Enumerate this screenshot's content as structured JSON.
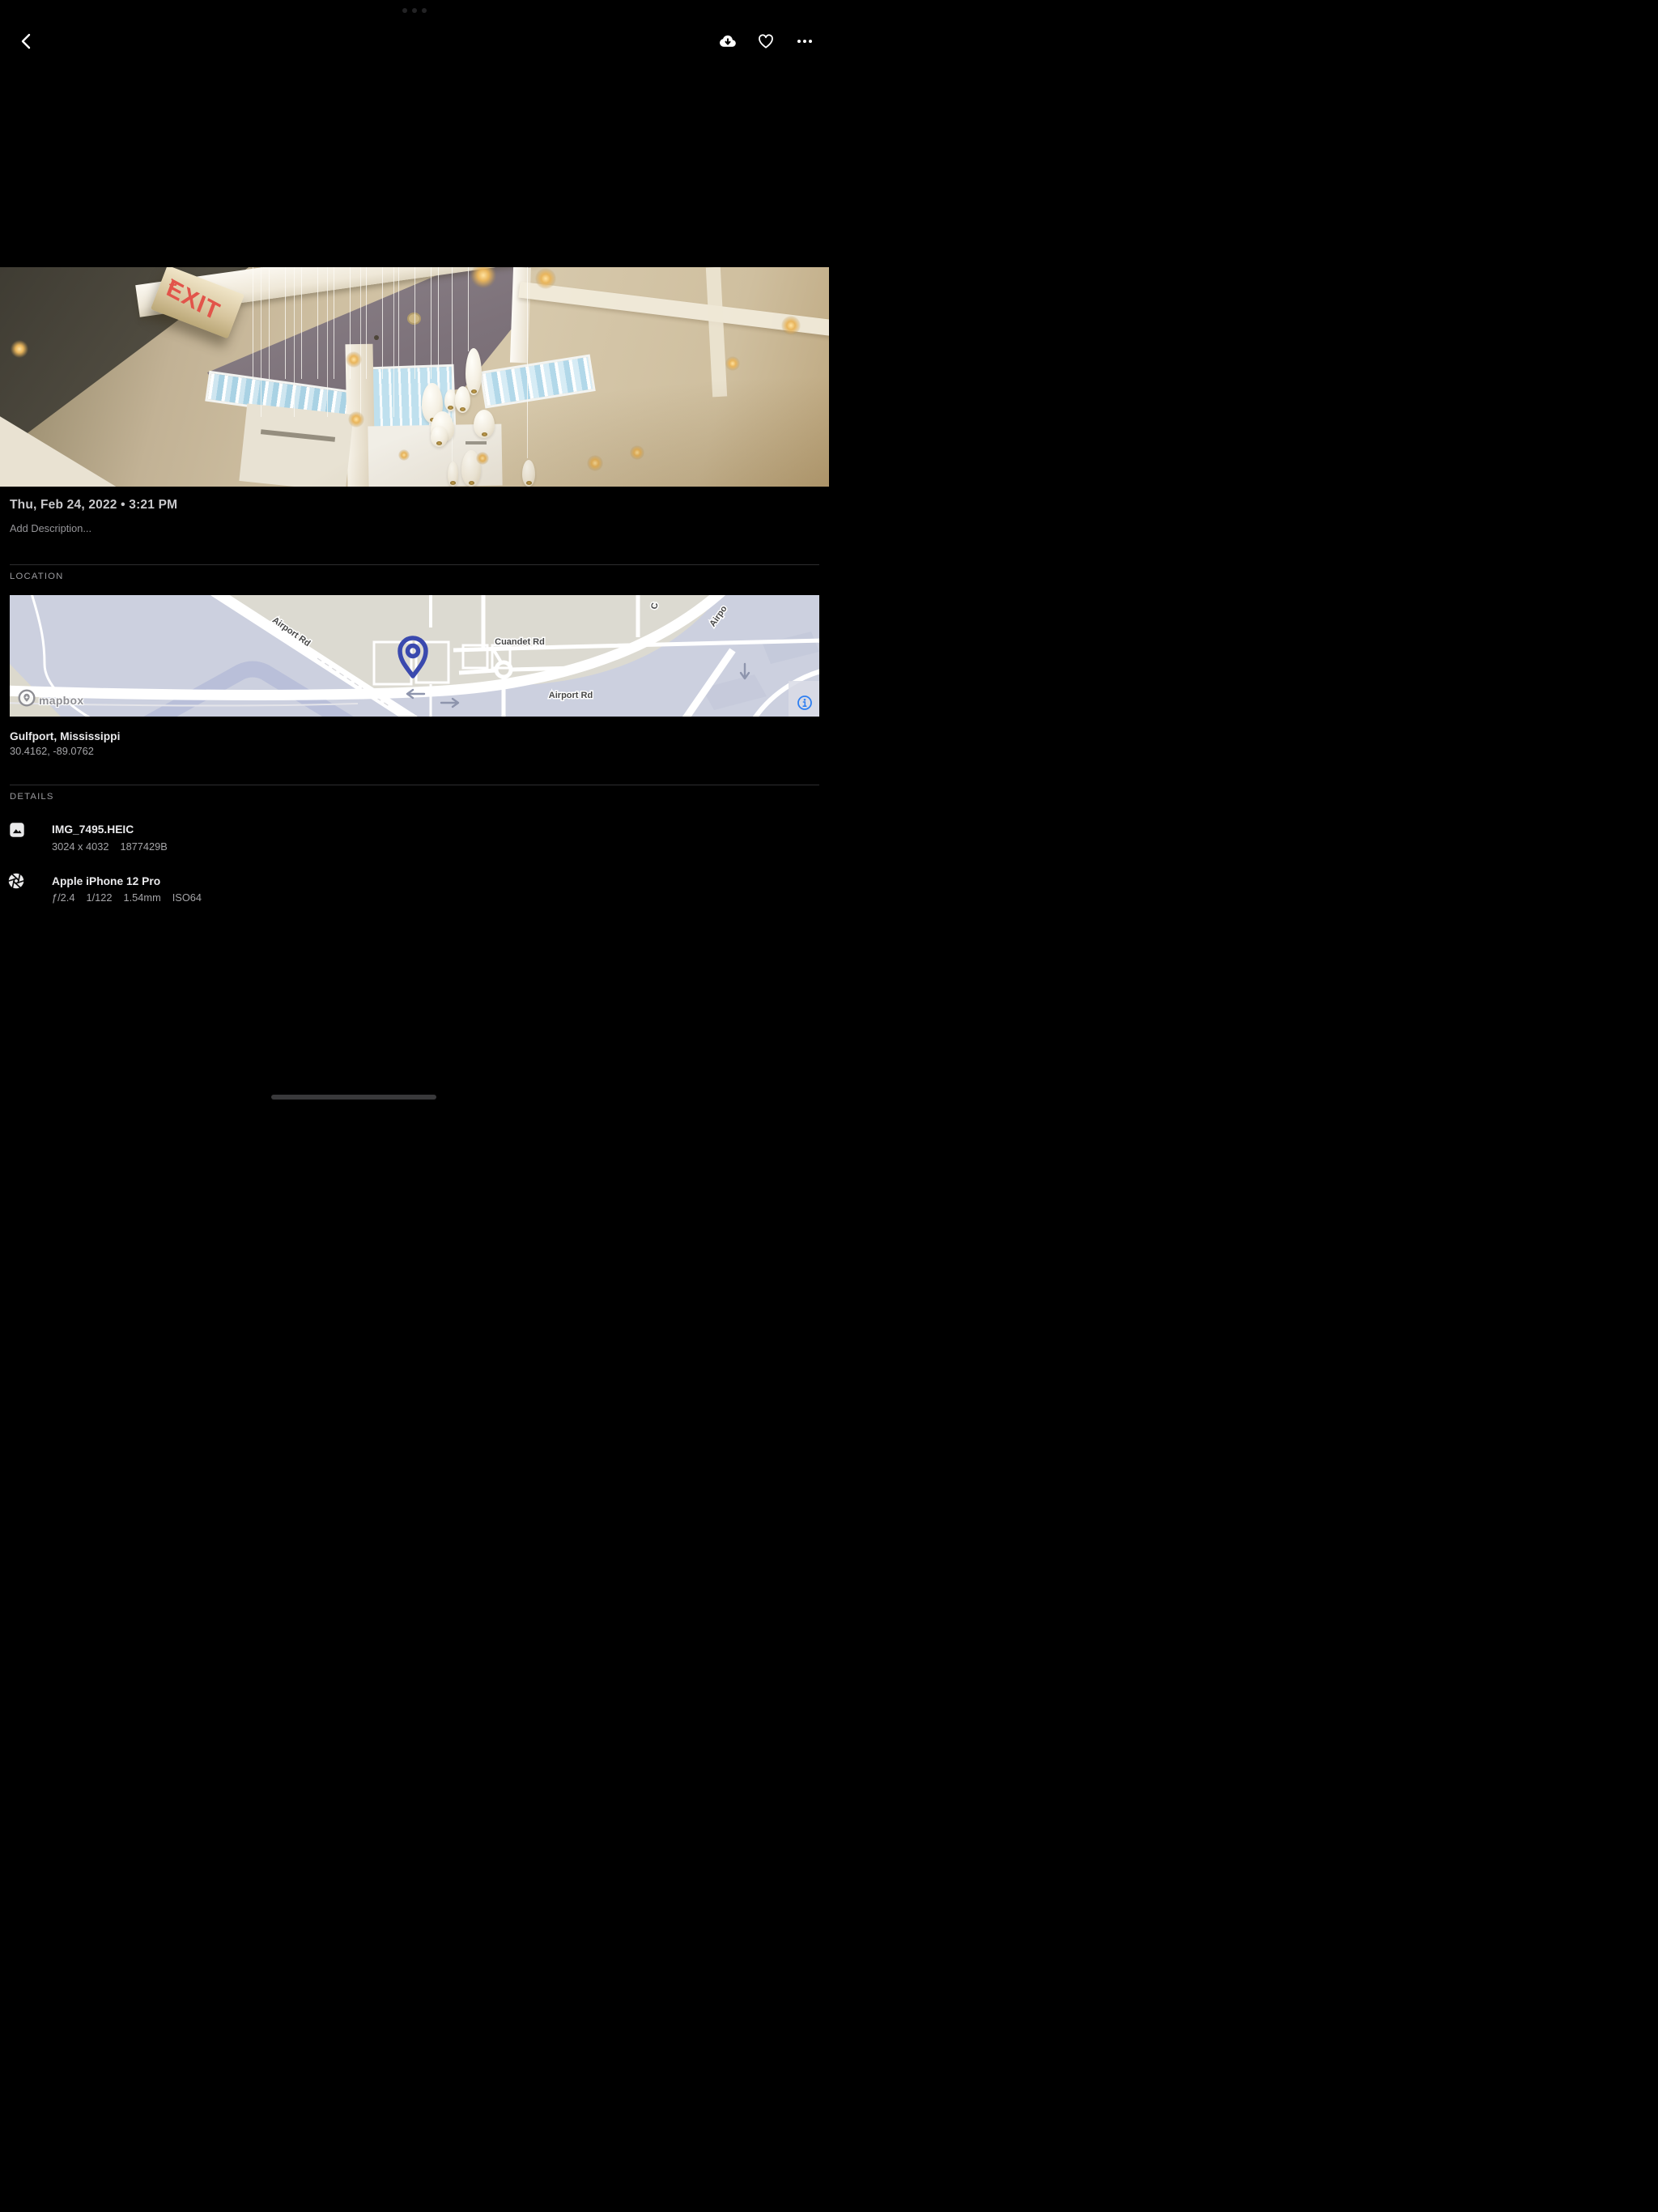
{
  "colors": {
    "background": "#000000",
    "map_pin_blue": "#3A49AE",
    "info_icon_blue": "#2E7FF2",
    "exit_sign_red": "#E2544A",
    "map_land": "#DCDAD1",
    "map_base": "#CCD0DF"
  },
  "top_bar": {
    "back_icon": "chevron-left",
    "download_icon": "cloud-download",
    "favorite_icon": "heart-outline",
    "more_icon": "ellipsis"
  },
  "photo": {
    "exit_sign": "EXIT",
    "exit_arrow": ">"
  },
  "metadata": {
    "datetime": "Thu, Feb 24, 2022 • 3:21 PM",
    "description_placeholder": "Add Description..."
  },
  "location": {
    "section_label": "LOCATION",
    "place": "Gulfport, Mississippi",
    "coordinates": "30.4162, -89.0762",
    "map": {
      "street_labels": {
        "airport_rd_upper": "Airport Rd",
        "cuandet_rd": "Cuandet Rd",
        "airport_rd_lower": "Airport Rd",
        "partial_c": "C",
        "partial_airport": "Airpo"
      },
      "attribution": "mapbox"
    }
  },
  "details": {
    "section_label": "DETAILS",
    "file": {
      "name": "IMG_7495.HEIC",
      "dimensions": "3024 x 4032",
      "size": "1877429B"
    },
    "camera": {
      "name": "Apple iPhone 12 Pro",
      "aperture": "ƒ/2.4",
      "shutter": "1/122",
      "focal_length": "1.54mm",
      "iso": "ISO64"
    }
  }
}
